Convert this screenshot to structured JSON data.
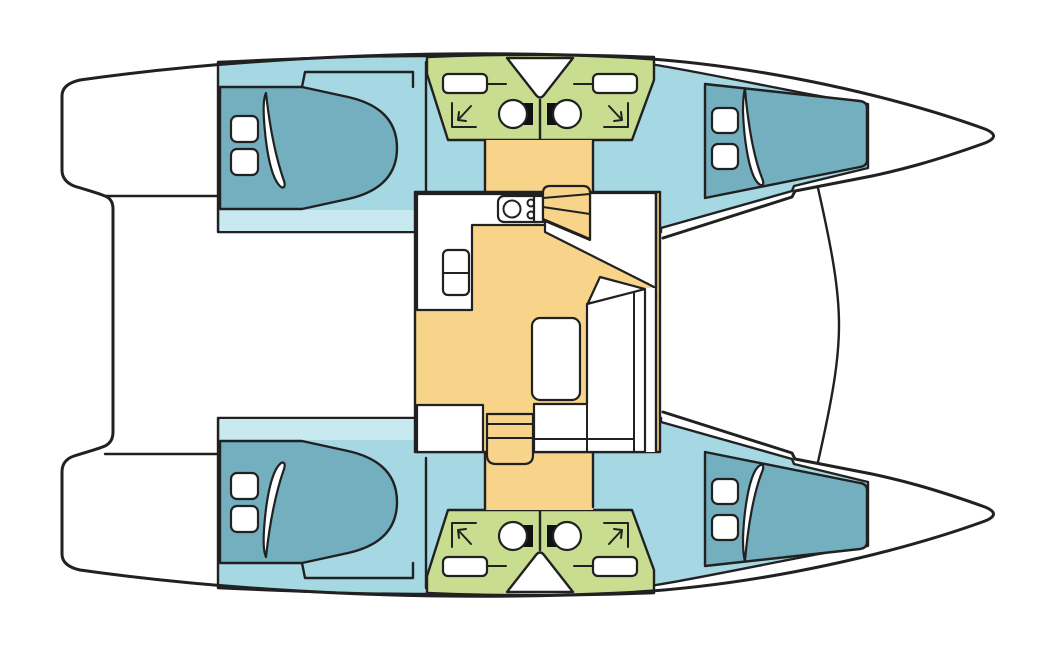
{
  "document": {
    "title": "Catamaran deck layout floor plan",
    "orientation": {
      "bow": "right",
      "stern": "left",
      "top_hull": "port",
      "bottom_hull": "starboard"
    }
  },
  "colors": {
    "outline": "#212121",
    "deck_white": "#ffffff",
    "cabin_floor": "#a6d8e4",
    "berth": "#74afbf",
    "shelf_strip": "#c9e9f0",
    "bathroom": "#c8dd90",
    "saloon_floor": "#f8d48a",
    "fixture_white": "#ffffff",
    "toilet_tank": "#111111"
  },
  "legend": {
    "cabin_floor": "sleeping cabins (blue)",
    "berth": "double berths (dark teal)",
    "bathroom": "heads / shower rooms (green)",
    "saloon_floor": "saloon, galley and companionways (yellow)",
    "deck_white": "decks, cockpit and bows (white)"
  },
  "hulls": {
    "port": {
      "position": "top",
      "aft_cabin": {
        "type": "double-berth cabin",
        "fixtures": [
          "double berth",
          "pillow",
          "hatch",
          "hatch",
          "foot shelf"
        ]
      },
      "aft_head": {
        "type": "bathroom",
        "fixtures": [
          "toilet",
          "sink",
          "shower"
        ]
      },
      "forward_head": {
        "type": "bathroom",
        "fixtures": [
          "toilet",
          "sink",
          "shower"
        ]
      },
      "forward_cabin": {
        "type": "double-berth cabin",
        "fixtures": [
          "double berth",
          "pillow",
          "hatch",
          "hatch"
        ]
      }
    },
    "starboard": {
      "position": "bottom",
      "aft_cabin": {
        "type": "double-berth cabin",
        "fixtures": [
          "double berth",
          "pillow",
          "hatch",
          "hatch",
          "foot shelf"
        ]
      },
      "aft_head": {
        "type": "bathroom",
        "fixtures": [
          "toilet",
          "sink",
          "shower"
        ]
      },
      "forward_head": {
        "type": "bathroom",
        "fixtures": [
          "toilet",
          "sink",
          "shower"
        ]
      },
      "forward_cabin": {
        "type": "double-berth cabin",
        "fixtures": [
          "double berth",
          "pillow",
          "hatch",
          "hatch"
        ]
      }
    }
  },
  "saloon": {
    "position": "center bridgedeck",
    "fixtures": [
      "galley counter",
      "stove with 3 burners",
      "fridge",
      "entry landing",
      "companionway steps to port hull",
      "companionway steps to starboard hull",
      "dining table",
      "L-shaped bench seat",
      "corner seat",
      "storage locker"
    ]
  },
  "deck": {
    "features": [
      "stern steps",
      "cockpit",
      "side decks",
      "trampoline forward beam",
      "bow peaks"
    ]
  }
}
